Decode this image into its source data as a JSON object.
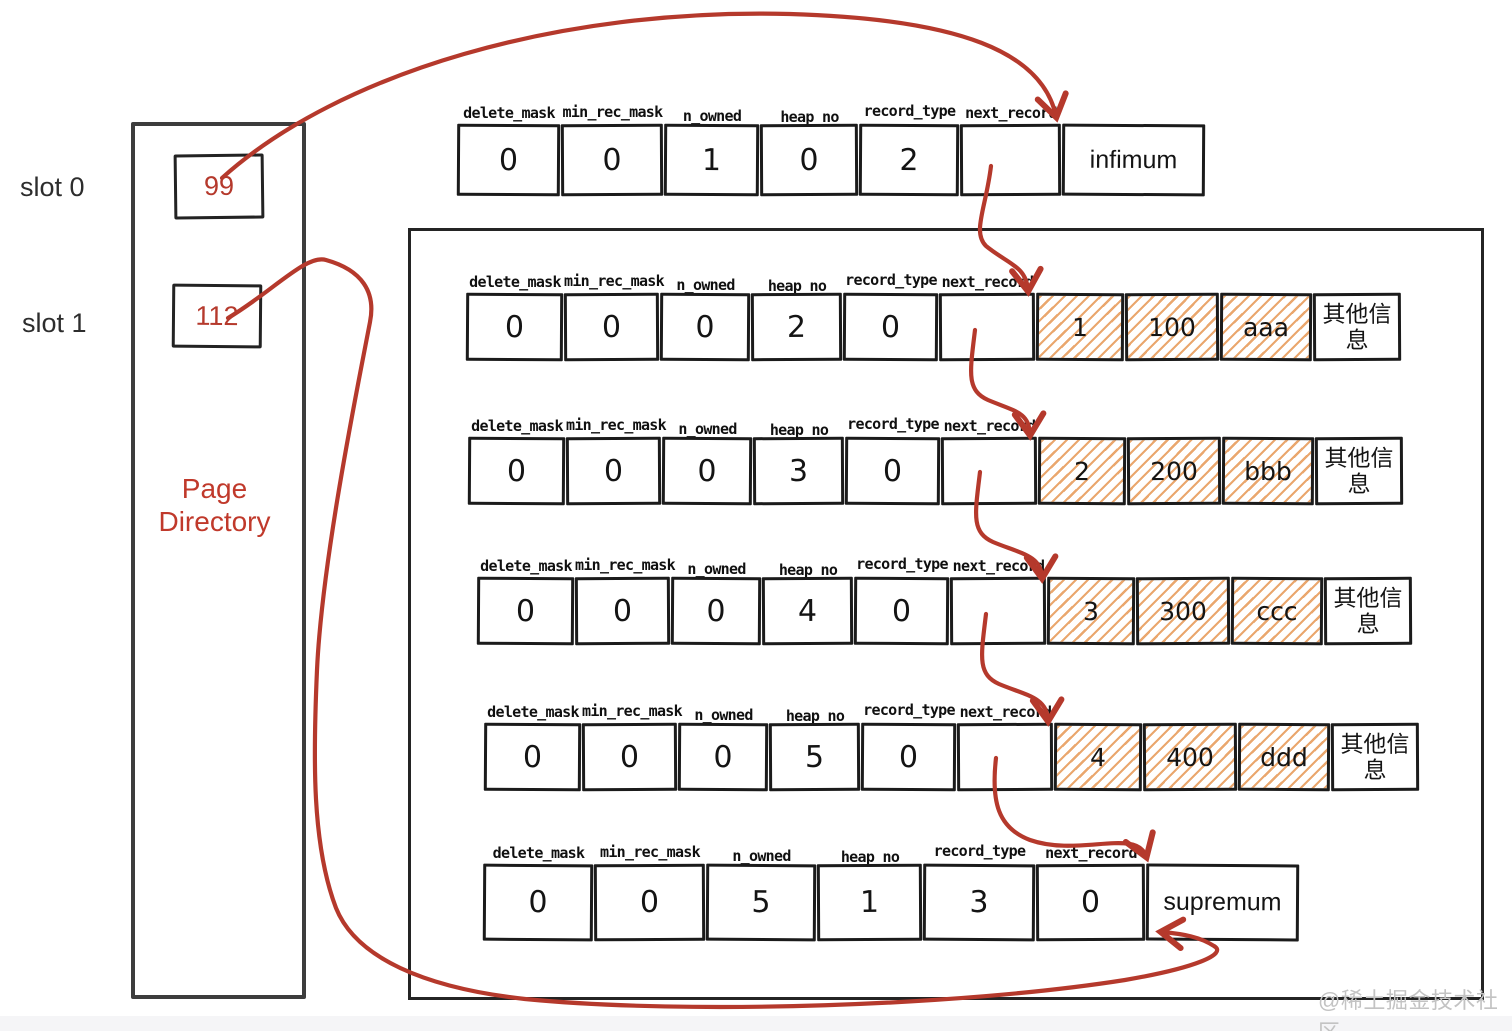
{
  "colors": {
    "accent_red": "#b5392c",
    "ink": "#1b1b1b",
    "hatch_orange": "#eaa76e",
    "watermark_gray": "#c3c3c3"
  },
  "page_directory": {
    "title": "Page Directory",
    "slots": [
      {
        "label": "slot 0",
        "value": "99"
      },
      {
        "label": "slot 1",
        "value": "112"
      }
    ]
  },
  "field_headers": [
    "delete_mask",
    "min_rec_mask",
    "n_owned",
    "heap_no",
    "record_type",
    "next_record"
  ],
  "infimum_record": {
    "fields": [
      "0",
      "0",
      "1",
      "0",
      "2",
      ""
    ],
    "name": "infimum"
  },
  "data_records": [
    {
      "fields": [
        "0",
        "0",
        "0",
        "2",
        "0",
        ""
      ],
      "cols": [
        "1",
        "100",
        "aaa"
      ],
      "extra": "其他信息"
    },
    {
      "fields": [
        "0",
        "0",
        "0",
        "3",
        "0",
        ""
      ],
      "cols": [
        "2",
        "200",
        "bbb"
      ],
      "extra": "其他信息"
    },
    {
      "fields": [
        "0",
        "0",
        "0",
        "4",
        "0",
        ""
      ],
      "cols": [
        "3",
        "300",
        "ccc"
      ],
      "extra": "其他信息"
    },
    {
      "fields": [
        "0",
        "0",
        "0",
        "5",
        "0",
        ""
      ],
      "cols": [
        "4",
        "400",
        "ddd"
      ],
      "extra": "其他信息"
    }
  ],
  "supremum_record": {
    "fields": [
      "0",
      "0",
      "5",
      "1",
      "3",
      "0"
    ],
    "name": "supremum"
  },
  "watermark": "@稀土掘金技术社区"
}
